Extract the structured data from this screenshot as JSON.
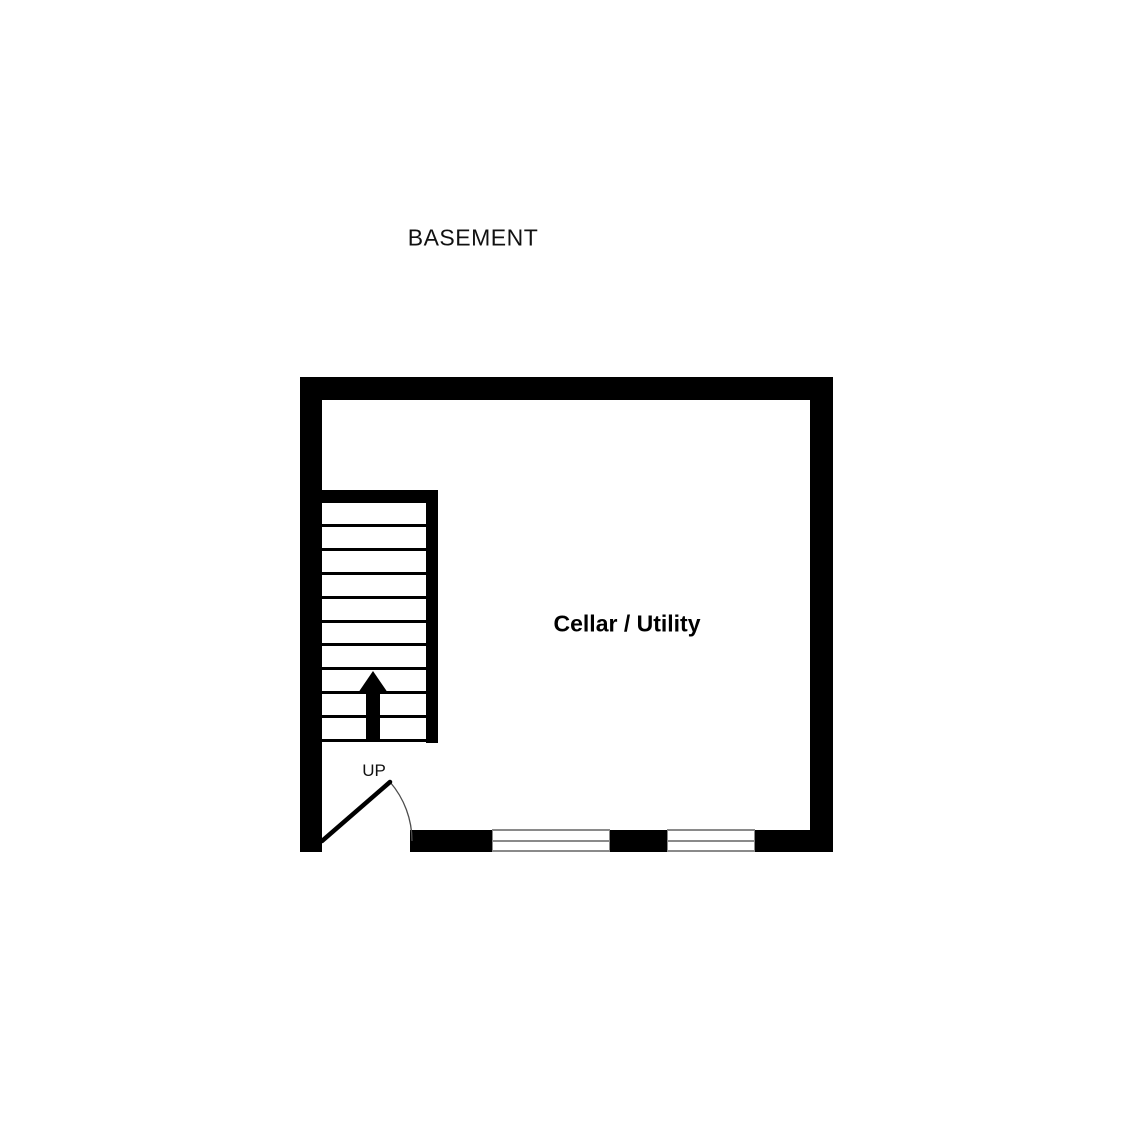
{
  "title": "BASEMENT",
  "floor_plan": {
    "room_label": "Cellar / Utility",
    "stairs": {
      "label": "UP",
      "tread_count": 10,
      "direction": "up"
    },
    "window_count": 2,
    "door_count": 1
  },
  "colors": {
    "wall": "#000000",
    "background": "#ffffff",
    "window_frame": "#8a8a8a",
    "door_arc": "#4d4d4d"
  }
}
